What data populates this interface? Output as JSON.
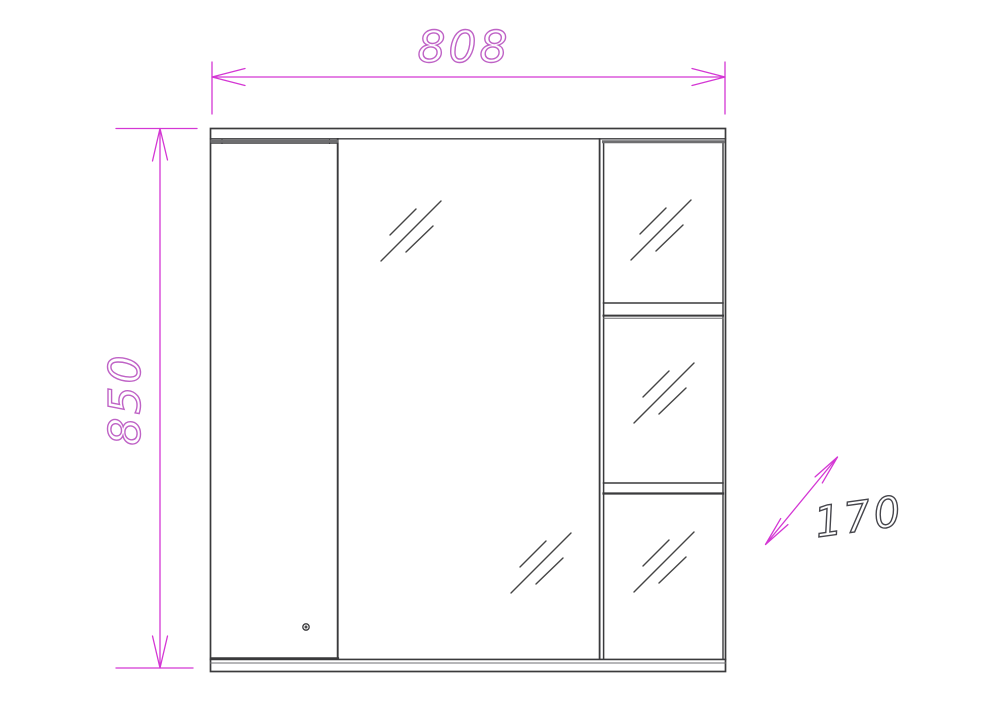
{
  "diagram": {
    "dimension_labels": {
      "width": "808",
      "height": "850",
      "depth": "170"
    },
    "colors": {
      "dimension_line": "#d437d4",
      "width_height_text": "#bf63c6",
      "depth_text": "#46464c",
      "cabinet_outline": "#3a3a3c",
      "panel_shadow": "#6e6e70",
      "glass_hatch": "#454545",
      "background": "#ffffff"
    },
    "symbols": {
      "glass_hatch": "double-diagonal-lines"
    }
  }
}
